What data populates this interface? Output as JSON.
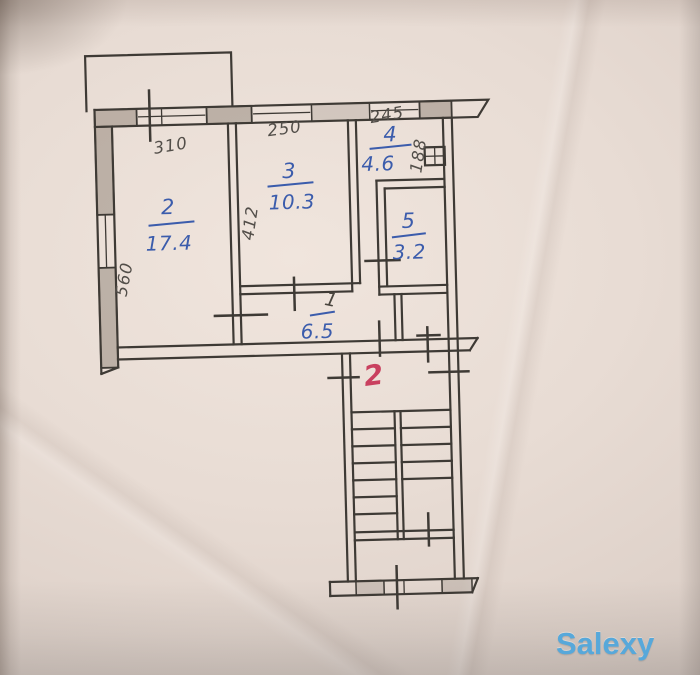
{
  "watermark": "Salexy",
  "plan": {
    "title": "apartment floor plan (scanned hand drawing)",
    "dimensions": {
      "room2_width": "310",
      "room2_depth": "560",
      "room3_width": "250",
      "room3_depth": "412",
      "room4_width": "245",
      "room4_depth": "188"
    },
    "rooms": [
      {
        "number": "2",
        "area": "17.4"
      },
      {
        "number": "3",
        "area": "10.3"
      },
      {
        "number": "4",
        "area": "4.6"
      },
      {
        "number": "5",
        "area": "3.2"
      },
      {
        "number": "1",
        "area": "6.5"
      }
    ],
    "entrance_label": "2",
    "stairs": {
      "left_treads": 6,
      "right_treads": 4,
      "tread_step": 17,
      "tread_start_y": 436
    }
  },
  "colors": {
    "ink": "#3e3a35",
    "blue_pen": "#3b5cac",
    "pencil": "#524e49",
    "red_mark": "#c9405f",
    "watermark_blue": "#57a8da",
    "paper": "#e8dcd4"
  }
}
